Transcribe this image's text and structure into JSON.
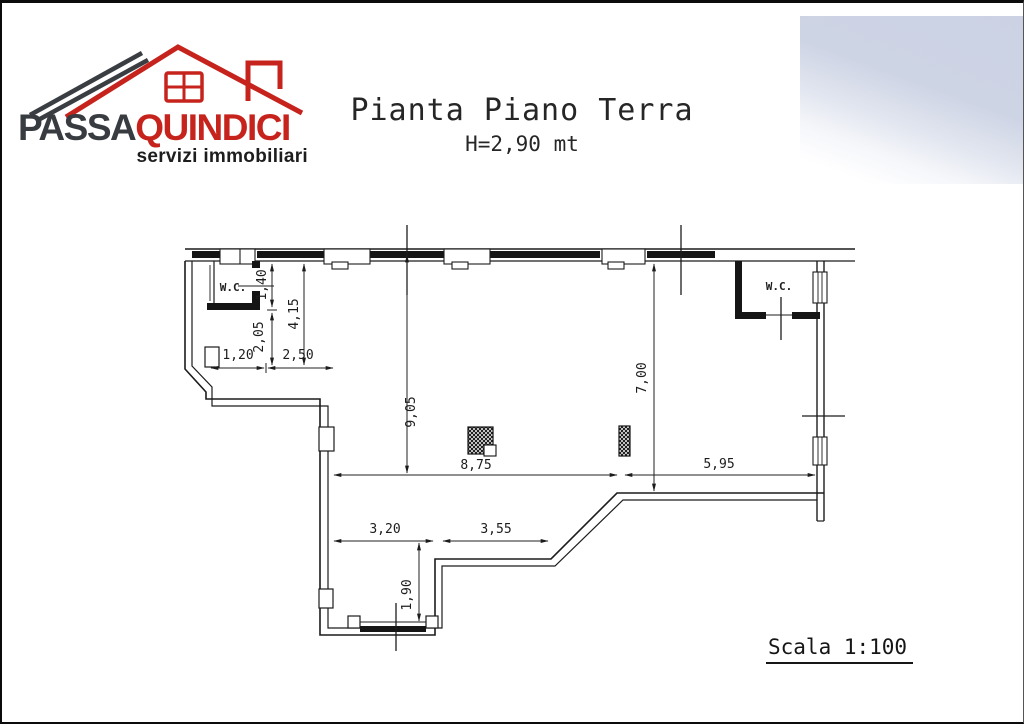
{
  "logo": {
    "brand_dark": "PASSA",
    "brand_red": "QUINDICI",
    "tagline": "servizi immobiliari"
  },
  "title": {
    "main": "Pianta Piano Terra",
    "subtitle": "H=2,90 mt"
  },
  "plan": {
    "rooms": {
      "wc_left": "W.C.",
      "wc_right": "W.C."
    },
    "dimensions": {
      "wc_height": "1,40",
      "left_inner": "2,05",
      "left_total": "4,15",
      "wc_width": "1,20",
      "entry_width": "2,50",
      "main_depth": "9,05",
      "right_depth": "7,00",
      "main_width": "8,75",
      "right_width": "5,95",
      "wing_left": "3,20",
      "wing_right": "3,55",
      "wing_depth": "1,90"
    }
  },
  "footer": {
    "scale_label": "Scala 1:100"
  },
  "colors": {
    "brand_red": "#c6231d",
    "brand_dark": "#383c40",
    "line": "#1c1c1c",
    "scan_artifact": "#c9d0e2"
  }
}
